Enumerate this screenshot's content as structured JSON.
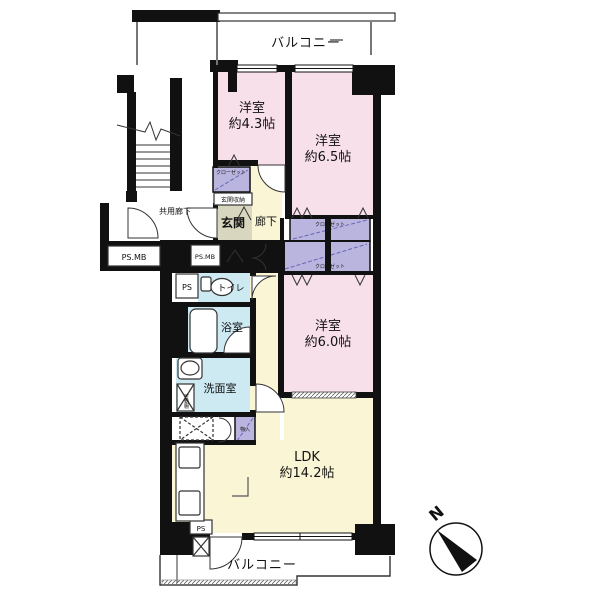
{
  "floorplan": {
    "balcony_top": "バルコニー",
    "balcony_bottom": "バルコニー",
    "common_corridor": "共用廊下",
    "entrance": "玄関",
    "hallway": "廊下",
    "entrance_storage": "玄関収納",
    "toilet": "トイレ",
    "bathroom": "浴室",
    "washroom": "洗面室",
    "movable_shelf": "可動棚",
    "rooms": {
      "western_43": {
        "name": "洋室",
        "size": "約4.3帖"
      },
      "western_65": {
        "name": "洋室",
        "size": "約6.5帖"
      },
      "western_60": {
        "name": "洋室",
        "size": "約6.0帖"
      },
      "ldk": {
        "name": "LDK",
        "size": "約14.2帖"
      }
    },
    "closets": {
      "room43": "クローゼット",
      "center_top": "クローゼット",
      "center_bottom": "クローゼット"
    },
    "storages": {
      "hall": "物入",
      "lower": "物入"
    },
    "shafts": {
      "ps_mb_left": "PS.MB",
      "ps_mb_right": "PS.MB",
      "ps_upper": "PS",
      "ps_lower": "PS"
    },
    "compass": {
      "north": "N"
    }
  },
  "colors": {
    "wall": "#111111",
    "room_pink": "#F8E0EB",
    "ldk_yellow": "#FAF6D5",
    "closet_purple": "#B9B5DF",
    "water_blue": "#CDE9F2",
    "entrance_beige": "#D9D6C0",
    "line": "#333333"
  }
}
